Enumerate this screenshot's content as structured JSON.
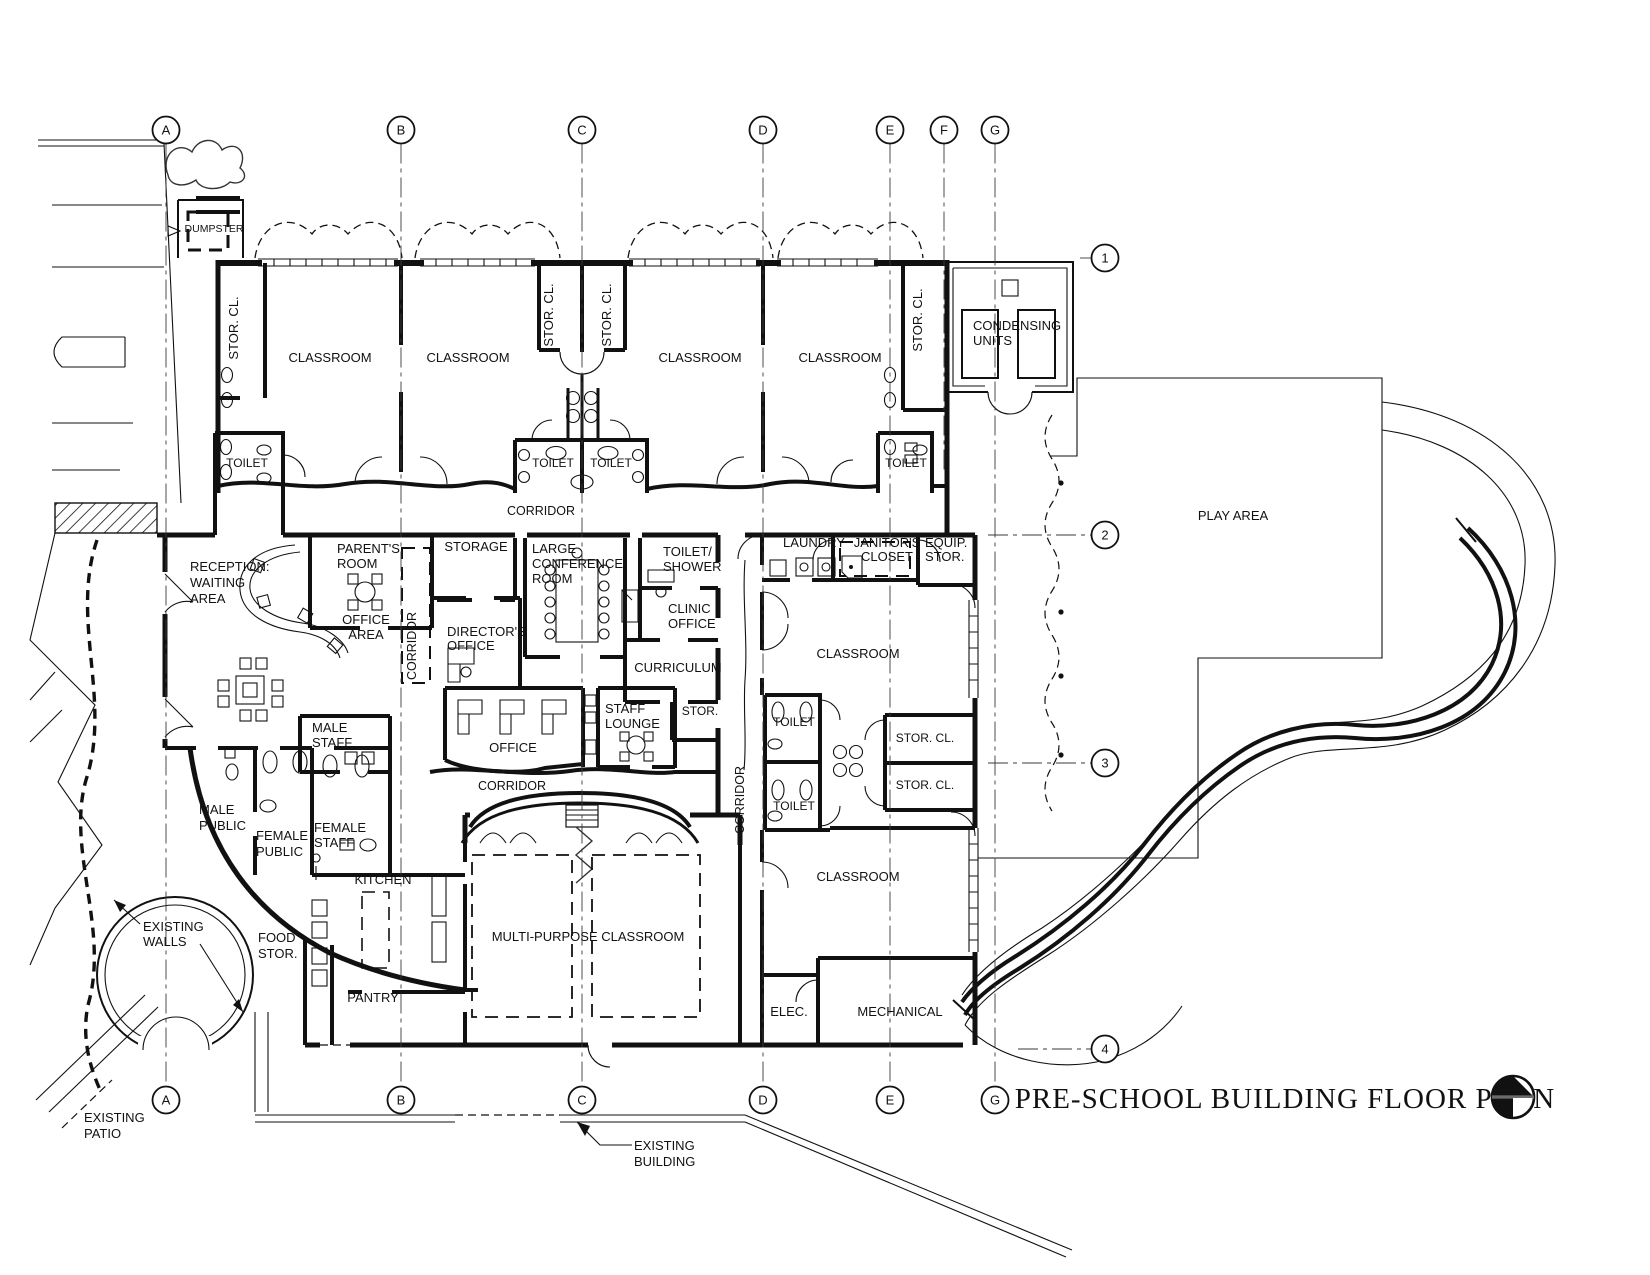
{
  "title": {
    "text": "PRE-SCHOOL BUILDING FLOOR PLAN"
  },
  "grid": {
    "radius": 13.5,
    "top_y": 130,
    "bottom_y": 1100,
    "right_x": 1105,
    "top_bubbles": [
      {
        "label": "A",
        "x": 166,
        "line_end": 1086
      },
      {
        "label": "B",
        "x": 401,
        "line_end": 1086
      },
      {
        "label": "C",
        "x": 582,
        "line_end": 1086
      },
      {
        "label": "D",
        "x": 763,
        "line_end": 1086
      },
      {
        "label": "E",
        "x": 890,
        "line_end": 1086
      },
      {
        "label": "F",
        "x": 944,
        "line_end": 470
      },
      {
        "label": "G",
        "x": 995,
        "line_end": 1086
      }
    ],
    "bottom_bubbles": [
      {
        "label": "A",
        "x": 166
      },
      {
        "label": "B",
        "x": 401
      },
      {
        "label": "C",
        "x": 582
      },
      {
        "label": "D",
        "x": 763
      },
      {
        "label": "E",
        "x": 890
      },
      {
        "label": "G",
        "x": 995
      }
    ],
    "right_bubbles": [
      {
        "label": "1",
        "y": 258,
        "x1": 1080
      },
      {
        "label": "2",
        "y": 535,
        "x1": 988
      },
      {
        "label": "3",
        "y": 763,
        "x1": 988
      },
      {
        "label": "4",
        "y": 1049,
        "x1": 1018
      }
    ]
  },
  "labels": [
    {
      "name": "stor-cl-left",
      "lines": [
        "STOR. CL."
      ],
      "x": 238,
      "y": 328,
      "rot": -90
    },
    {
      "name": "classroom-1",
      "lines": [
        "CLASSROOM"
      ],
      "x": 330,
      "y": 362
    },
    {
      "name": "classroom-2",
      "lines": [
        "CLASSROOM"
      ],
      "x": 468,
      "y": 362
    },
    {
      "name": "stor-cl-center-left",
      "lines": [
        "STOR. CL."
      ],
      "x": 553,
      "y": 315,
      "rot": -90
    },
    {
      "name": "stor-cl-center-right",
      "lines": [
        "STOR. CL."
      ],
      "x": 611,
      "y": 315,
      "rot": -90
    },
    {
      "name": "classroom-3",
      "lines": [
        "CLASSROOM"
      ],
      "x": 700,
      "y": 362
    },
    {
      "name": "classroom-4",
      "lines": [
        "CLASSROOM"
      ],
      "x": 840,
      "y": 362
    },
    {
      "name": "stor-cl-right-top",
      "lines": [
        "STOR. CL."
      ],
      "x": 922,
      "y": 320,
      "rot": -90
    },
    {
      "name": "toilet-classroom-left",
      "lines": [
        "TOILET"
      ],
      "x": 247,
      "y": 467,
      "size": 12
    },
    {
      "name": "toilet-classroom-c1",
      "lines": [
        "TOILET"
      ],
      "x": 553,
      "y": 467,
      "size": 12
    },
    {
      "name": "toilet-classroom-c2",
      "lines": [
        "TOILET"
      ],
      "x": 611,
      "y": 467,
      "size": 12
    },
    {
      "name": "toilet-classroom-right",
      "lines": [
        "TOILET"
      ],
      "x": 906,
      "y": 467,
      "size": 12
    },
    {
      "name": "corridor-north",
      "lines": [
        "CORRIDOR"
      ],
      "x": 541,
      "y": 515,
      "size": 12.5
    },
    {
      "name": "dumpster",
      "lines": [
        "DUMPSTER"
      ],
      "x": 214,
      "y": 232,
      "size": 10.5
    },
    {
      "name": "condensing-units",
      "lines": [
        "CONDENSING",
        "UNITS"
      ],
      "x": 973,
      "y": 330,
      "anchor": "start",
      "lh": 15
    },
    {
      "name": "reception-waiting-area",
      "lines": [
        "RECEPTION:",
        "WAITING",
        "AREA"
      ],
      "x": 190,
      "y": 571,
      "anchor": "start",
      "lh": 16
    },
    {
      "name": "parents-room",
      "lines": [
        "PARENT'S",
        "ROOM"
      ],
      "x": 337,
      "y": 553,
      "anchor": "start",
      "lh": 15
    },
    {
      "name": "office-area",
      "lines": [
        "OFFICE",
        "AREA"
      ],
      "x": 366,
      "y": 624,
      "lh": 15
    },
    {
      "name": "corridor-admin",
      "lines": [
        "CORRIDOR"
      ],
      "x": 416,
      "y": 646,
      "rot": -90,
      "size": 12.5
    },
    {
      "name": "storage",
      "lines": [
        "STORAGE"
      ],
      "x": 476,
      "y": 551
    },
    {
      "name": "directors-office",
      "lines": [
        "DIRECTOR'S",
        "OFFICE"
      ],
      "x": 447,
      "y": 636,
      "anchor": "start",
      "lh": 14
    },
    {
      "name": "large-conference-room",
      "lines": [
        "LARGE",
        "CONFERENCE",
        "ROOM"
      ],
      "x": 532,
      "y": 553,
      "anchor": "start",
      "lh": 15
    },
    {
      "name": "toilet-shower",
      "lines": [
        "TOILET/",
        "SHOWER"
      ],
      "x": 663,
      "y": 556,
      "anchor": "start",
      "lh": 15
    },
    {
      "name": "clinic-office",
      "lines": [
        "CLINIC",
        "OFFICE"
      ],
      "x": 668,
      "y": 613,
      "anchor": "start",
      "lh": 15
    },
    {
      "name": "curriculum",
      "lines": [
        "CURRICULUM"
      ],
      "x": 678,
      "y": 672
    },
    {
      "name": "staff-lounge",
      "lines": [
        "STAFF",
        "LOUNGE"
      ],
      "x": 605,
      "y": 713,
      "anchor": "start",
      "lh": 15
    },
    {
      "name": "stor-admin",
      "lines": [
        "STOR."
      ],
      "x": 700,
      "y": 715,
      "size": 12
    },
    {
      "name": "office",
      "lines": [
        "OFFICE"
      ],
      "x": 513,
      "y": 752
    },
    {
      "name": "male-staff",
      "lines": [
        "MALE",
        "STAFF"
      ],
      "x": 312,
      "y": 732,
      "anchor": "start",
      "lh": 15
    },
    {
      "name": "corridor-south",
      "lines": [
        "CORRIDOR"
      ],
      "x": 512,
      "y": 790,
      "size": 12.5
    },
    {
      "name": "laundry",
      "lines": [
        "LAUNDRY"
      ],
      "x": 814,
      "y": 547
    },
    {
      "name": "janitors-closet",
      "lines": [
        "JANITOR'S",
        "CLOSET"
      ],
      "x": 887,
      "y": 547,
      "lh": 14
    },
    {
      "name": "equip-stor",
      "lines": [
        "EQUIP.",
        "STOR."
      ],
      "x": 925,
      "y": 547,
      "anchor": "start",
      "lh": 14
    },
    {
      "name": "classroom-middle-right",
      "lines": [
        "CLASSROOM"
      ],
      "x": 858,
      "y": 658
    },
    {
      "name": "toilet-right-1",
      "lines": [
        "TOILET"
      ],
      "x": 794,
      "y": 726,
      "size": 12
    },
    {
      "name": "toilet-right-2",
      "lines": [
        "TOILET"
      ],
      "x": 794,
      "y": 810,
      "size": 12
    },
    {
      "name": "stor-cl-right-1",
      "lines": [
        "STOR. CL."
      ],
      "x": 925,
      "y": 742,
      "size": 12
    },
    {
      "name": "stor-cl-right-2",
      "lines": [
        "STOR. CL."
      ],
      "x": 925,
      "y": 789,
      "size": 12
    },
    {
      "name": "corridor-east",
      "lines": [
        "CORRIDOR"
      ],
      "x": 744,
      "y": 800,
      "rot": -90,
      "size": 12.5
    },
    {
      "name": "classroom-bottom-right",
      "lines": [
        "CLASSROOM"
      ],
      "x": 858,
      "y": 881
    },
    {
      "name": "elec",
      "lines": [
        "ELEC."
      ],
      "x": 789,
      "y": 1016
    },
    {
      "name": "mechanical",
      "lines": [
        "MECHANICAL"
      ],
      "x": 900,
      "y": 1016
    },
    {
      "name": "male-public",
      "lines": [
        "MALE",
        "PUBLIC"
      ],
      "x": 199,
      "y": 814,
      "anchor": "start",
      "lh": 16
    },
    {
      "name": "female-public",
      "lines": [
        "FEMALE",
        "PUBLIC"
      ],
      "x": 256,
      "y": 840,
      "anchor": "start",
      "lh": 16
    },
    {
      "name": "female-staff",
      "lines": [
        "FEMALE",
        "STAFF"
      ],
      "x": 314,
      "y": 832,
      "anchor": "start",
      "lh": 15
    },
    {
      "name": "kitchen",
      "lines": [
        "KITCHEN"
      ],
      "x": 383,
      "y": 884
    },
    {
      "name": "food-stor",
      "lines": [
        "FOOD",
        "STOR."
      ],
      "x": 258,
      "y": 942,
      "anchor": "start",
      "lh": 16
    },
    {
      "name": "pantry",
      "lines": [
        "PANTRY"
      ],
      "x": 373,
      "y": 1002
    },
    {
      "name": "multi-purpose-classroom",
      "lines": [
        "MULTI-PURPOSE CLASSROOM"
      ],
      "x": 588,
      "y": 941
    },
    {
      "name": "existing-walls",
      "lines": [
        "EXISTING",
        "WALLS"
      ],
      "x": 143,
      "y": 931,
      "anchor": "start",
      "lh": 15
    },
    {
      "name": "existing-patio",
      "lines": [
        "EXISTING",
        "PATIO"
      ],
      "x": 84,
      "y": 1122,
      "anchor": "start",
      "lh": 16
    },
    {
      "name": "existing-building",
      "lines": [
        "EXISTING",
        "BUILDING"
      ],
      "x": 634,
      "y": 1150,
      "anchor": "start",
      "lh": 16
    },
    {
      "name": "play-area",
      "lines": [
        "PLAY AREA"
      ],
      "x": 1233,
      "y": 520
    }
  ]
}
